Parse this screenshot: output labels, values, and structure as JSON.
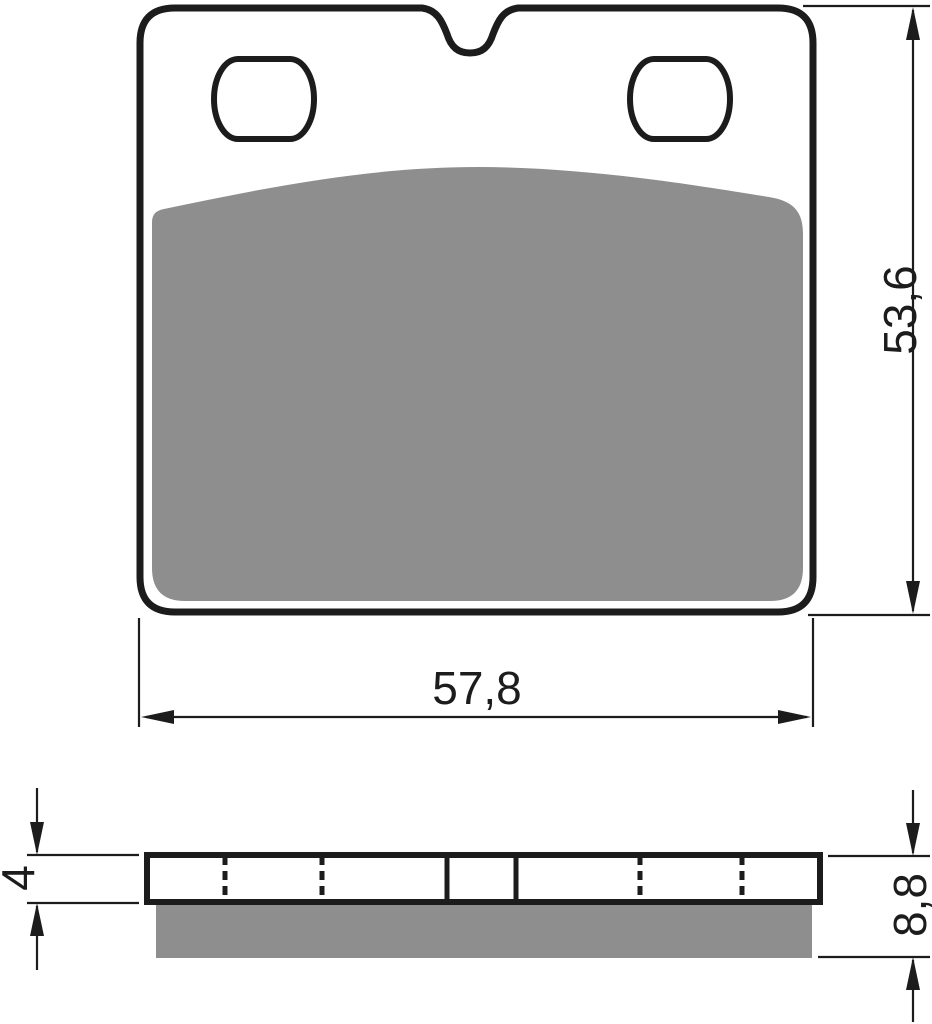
{
  "front_view": {
    "dim_width_label": "57,8",
    "dim_height_label": "53,6"
  },
  "side_view": {
    "dim_backplate_thickness_label": "4",
    "dim_total_thickness_label": "8,8"
  },
  "colors": {
    "outline": "#1c1c1c",
    "friction": "#8e8e8e",
    "background": "#ffffff"
  }
}
